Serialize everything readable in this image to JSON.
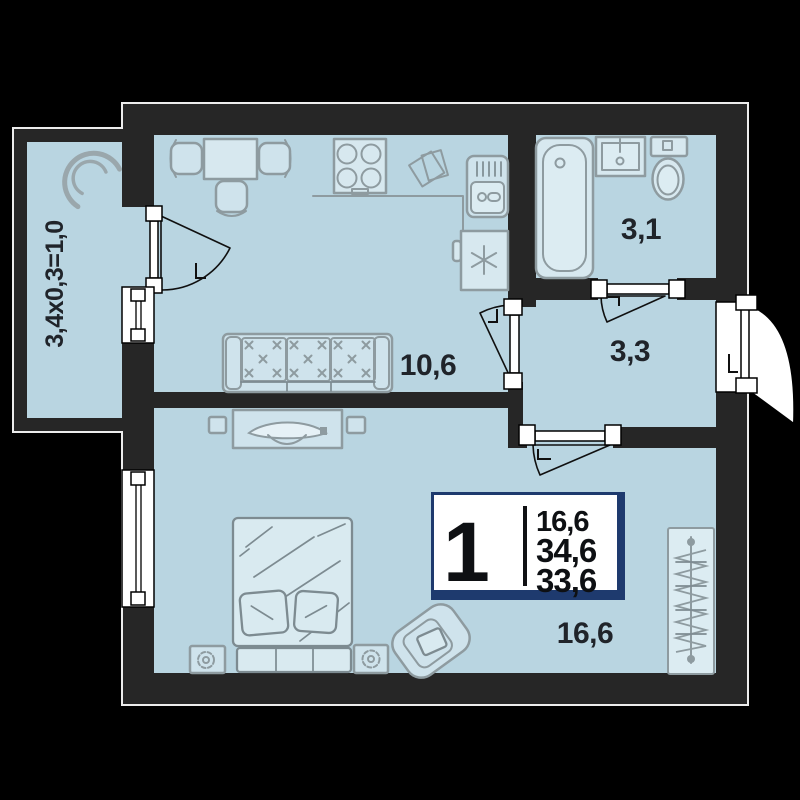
{
  "plan": {
    "labels": {
      "balcony_formula": "3,4х0,3=1,0",
      "kitchen_living_area": "10,6",
      "bathroom_area": "3,1",
      "hallway_area": "3,3",
      "bedroom_area": "16,6"
    },
    "badge": {
      "rooms": "1",
      "living_area": "16,6",
      "total_area": "34,6",
      "reduced_total_area": "33,6"
    },
    "colors": {
      "background": "#000000",
      "wall": "#262626",
      "floor": "#b9d5e1",
      "furniture_fill": "#cfe3ec",
      "furniture_stroke": "#8e9ba0",
      "badge_border": "#1e3a6e",
      "badge_background": "#ffffff",
      "label_text": "#20242a"
    },
    "icons": [
      "balcony-chair-icon",
      "dining-table-icon",
      "chair-icon",
      "stove-icon",
      "kitchen-sink-icon",
      "fridge-icon",
      "snowflake-icon",
      "wall-board-icon",
      "sofa-icon",
      "tv-stand-icon",
      "speaker-icon",
      "bed-icon",
      "pillow-icon",
      "nightstand-icon",
      "plant-icon",
      "armchair-icon",
      "wardrobe-hangers-icon",
      "bathtub-icon",
      "washbasin-icon",
      "toilet-icon",
      "door-swing-icon",
      "window-icon"
    ]
  }
}
